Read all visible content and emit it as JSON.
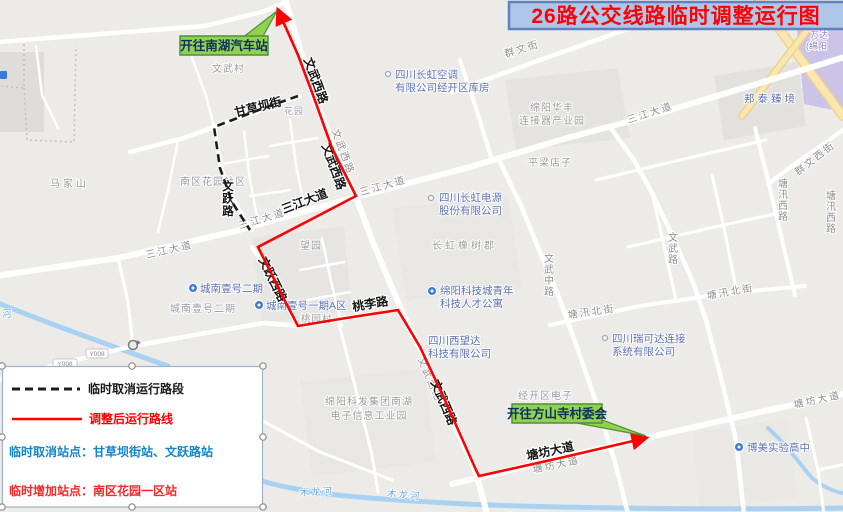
{
  "title": "26路公交线路临时调整运行图",
  "callouts": {
    "north": "开往南湖汽车站",
    "south": "开往方山寺村委会"
  },
  "legend": {
    "cancelled_segment": "临时取消运行路段",
    "adjusted_route": "调整后运行路线",
    "cancelled_stops": "临时取消站点：甘草坝街站、文跃路站",
    "added_stops": "临时增加站点：南区花园一区站"
  },
  "route_labels": {
    "gancaoba": "甘草坝街",
    "wenyue": "文跃路",
    "wenwu_west_a": "文武西路",
    "wenwu_west_b": "文武西路",
    "wenwu_west_c": "文武西路",
    "sanjiang": "三江大道",
    "wenyue_west": "文跃西路",
    "taoli": "桃李路",
    "tangfang": "塘坊大道"
  },
  "road_labels": {
    "sanjiang_w": "三江大道",
    "sanjiang_mid": "三江大道",
    "sanjiang_e": "三江大道",
    "sanjiang_ne": "三江大道",
    "wenwu_west_gray_n": "文武西路",
    "wenwu_west_gray_s": "文武西路",
    "qunwen_st": "群文街",
    "wenwu_mid": "文武中路",
    "wenwu": "文武路",
    "tangxun_north_e": "塘汛北街",
    "tangxun_north_w": "塘汛北街",
    "tangxun_west_a": "塘汛西路",
    "tangxun_west_b": "塘汛西路",
    "qunwen_west": "群文西街",
    "tangfang_e": "塘坊大道",
    "tangfang_mid": "塘坊大道",
    "y008_a": "Y008",
    "y008_b": "Y008"
  },
  "place_labels": {
    "majiashan": "马家山",
    "wenwucun": "文武村",
    "pingliangdianzi": "平梁店子",
    "wangyuan": "望园",
    "changhong_xiangshujun": "长虹橡树郡",
    "taoyuancun": "桃园村",
    "nanqu_huayuan_shequ": "南区花园社区",
    "chengnan_yihao_erqi_plain": "城南壹号二期",
    "huayuan": "花园",
    "huafeng_line1": "绵阳华丰",
    "huafeng_line2": "连接器产业园",
    "kefa_line1": "绵阳科发集团南湖",
    "kefa_line2": "电子信息工业园",
    "jingkaiqu_dianzi": "经开区电子",
    "mulonghe_a": "木龙河",
    "mulonghe_b": "木龙河",
    "he": "河"
  },
  "poi_labels": {
    "changhong_kongtiao_line1": "四川长虹空调",
    "changhong_kongtiao_line2": "有限公司经开区库房",
    "changhong_dianyuan_line1": "四川长虹电源",
    "changhong_dianyuan_line2": "股份有限公司",
    "bangtai_zhenjing": "邦泰臻境",
    "chengnan_yihao_erqi": "城南壹号二期",
    "chengnan_yihao_yiqi": "城南壹号一期A区",
    "keji_gongyu_line1": "绵阳科技城青年",
    "keji_gongyu_line2": "科技人才公寓",
    "xiwangda_line1": "四川西望达",
    "xiwangda_line2": "科技有限公司",
    "ruikeda_line1": "四川瑞可达连接",
    "ruikeda_line2": "系统有限公司",
    "bomei": "博美实验高中",
    "wanda": "万达",
    "mianyang_paren": "(绵阳"
  },
  "colors": {
    "route_red": "#ff0000",
    "cancelled_line": "#1c1c1c",
    "callout_fill": "#92d050",
    "callout_border": "#4e8f3a",
    "banner_fill": "#aec7e9",
    "banner_border": "#637fbe",
    "banner_text": "#ff0000",
    "legend_cancel_blue": "#1485cc",
    "legend_added_red": "#ff2626",
    "poi_blue": "#5e72b4",
    "road_label_gray": "#8e8e8e"
  }
}
